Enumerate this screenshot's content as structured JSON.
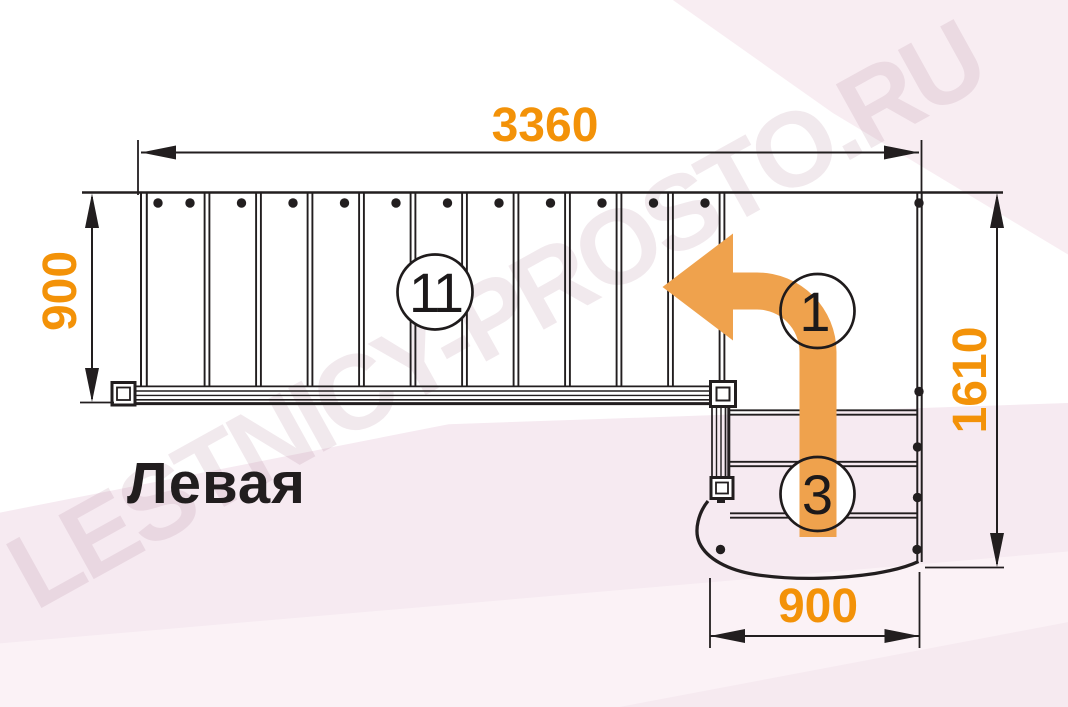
{
  "title": "Левая",
  "watermark": "LESTNICY-PROSTO.RU",
  "dimensions": {
    "top": "3360",
    "left": "900",
    "right": "1610",
    "bottom": "900"
  },
  "step_labels": {
    "upper_flight": "11",
    "first_step": "1",
    "lower_flight": "3"
  },
  "colors": {
    "dimension_text": "#F39208",
    "arrow": "#EFA24D",
    "line": "#221E1F",
    "background_pink": "#F6EAF1",
    "watermark": "#A87492"
  }
}
